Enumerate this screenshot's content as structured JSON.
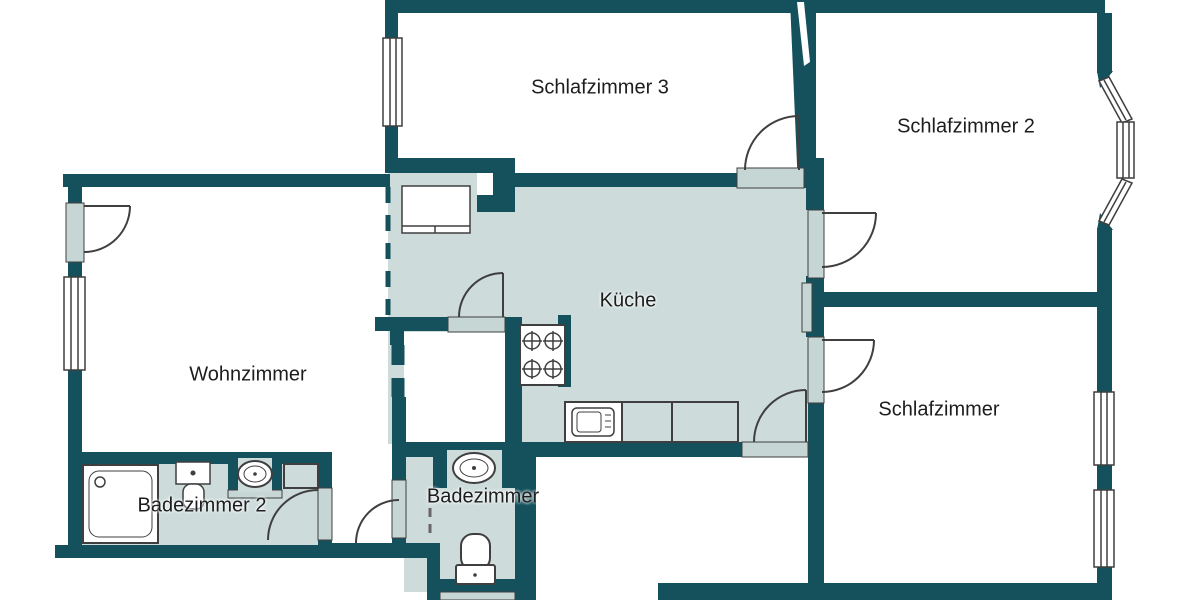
{
  "floorplan": {
    "rooms": [
      {
        "id": "schlafzimmer3",
        "label": "Schlafzimmer 3"
      },
      {
        "id": "schlafzimmer2",
        "label": "Schlafzimmer 2"
      },
      {
        "id": "kueche",
        "label": "Küche"
      },
      {
        "id": "wohnzimmer",
        "label": "Wohnzimmer"
      },
      {
        "id": "schlafzimmer",
        "label": "Schlafzimmer"
      },
      {
        "id": "badezimmer2",
        "label": "Badezimmer 2"
      },
      {
        "id": "badezimmer",
        "label": "Badezimmer"
      }
    ],
    "colors": {
      "wall": "#14515c",
      "room_fill": "#cddcdb",
      "door_sill": "#c6d6d5",
      "background": "#ffffff",
      "fixture_outline": "#3f3f3f",
      "label_text": "#1d1d1d"
    },
    "fixtures": {
      "kueche": [
        "kitchen-cabinet",
        "stove-4-burners",
        "kitchen-sink-counter",
        "radiator"
      ],
      "badezimmer2": [
        "shower",
        "toilet",
        "washbasin",
        "washing-machine"
      ],
      "badezimmer": [
        "washbasin",
        "toilet"
      ]
    },
    "door_count": 8,
    "window_count": 8
  }
}
